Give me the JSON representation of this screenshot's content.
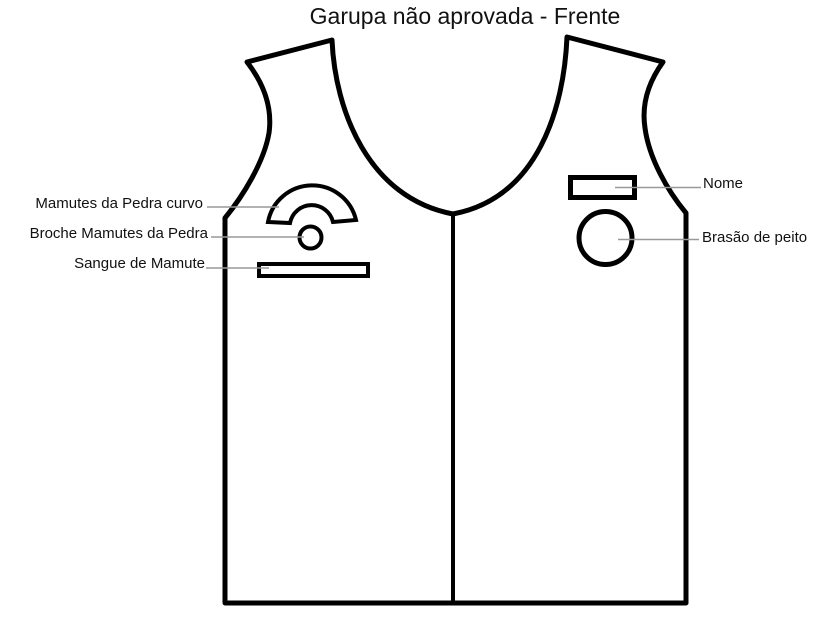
{
  "title": "Garupa não aprovada - Frente",
  "labels": {
    "rocker": "Mamutes da Pedra curvo",
    "brooch": "Broche Mamutes da Pedra",
    "blood_strip": "Sangue de Mamute",
    "name": "Nome",
    "chest_badge": "Brasão de peito"
  },
  "colors": {
    "outline": "#000000",
    "leader": "#999999",
    "text": "#111111",
    "background": "#ffffff"
  }
}
